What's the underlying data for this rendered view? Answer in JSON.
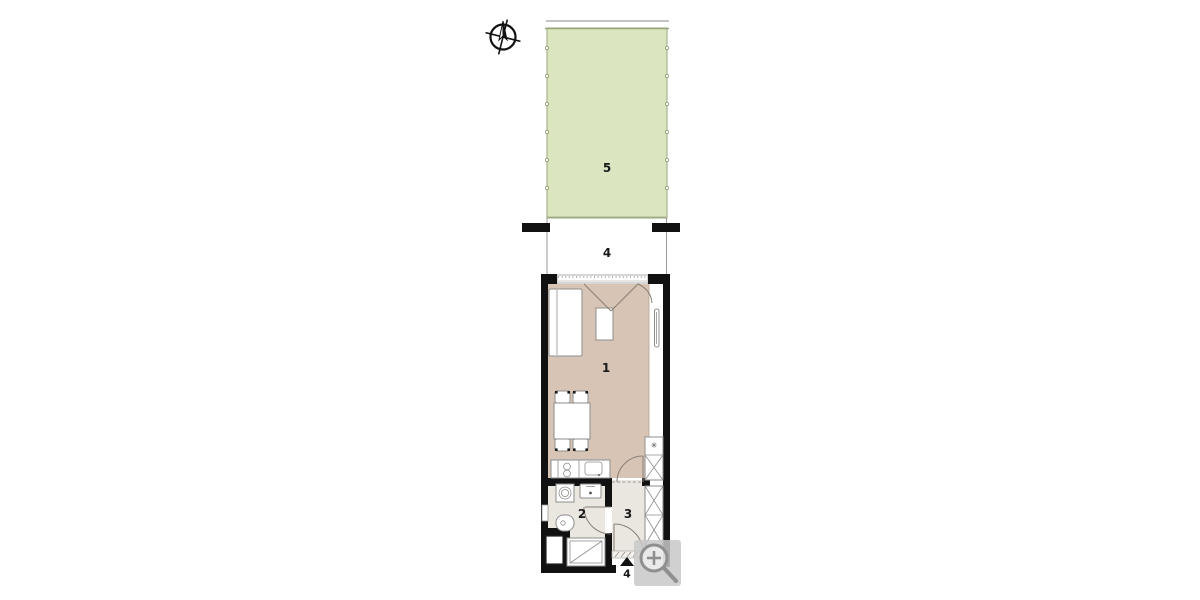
{
  "page": {
    "kind": "apartment floor plan",
    "background": "#ffffff"
  },
  "labels": {
    "living": "1",
    "bathroom": "2",
    "hall": "3",
    "terrace": "4",
    "garden": "5",
    "entrance_marker": "4"
  },
  "icons": {
    "compass": "compass-rose-north",
    "zoom_button": "zoom-in-magnifier",
    "shaft_glyph": "✳"
  },
  "colors": {
    "wall": "#111111",
    "garden_fill": "#dbe5c0",
    "garden_border": "#98a67c",
    "living_floor": "#d7c4b4",
    "wet_floor": "#eae6e0",
    "furniture_stroke": "#8e8e8e",
    "magnifier": "#8f8f8f",
    "magnifier_bg": "rgba(200,200,200,0.85)"
  }
}
